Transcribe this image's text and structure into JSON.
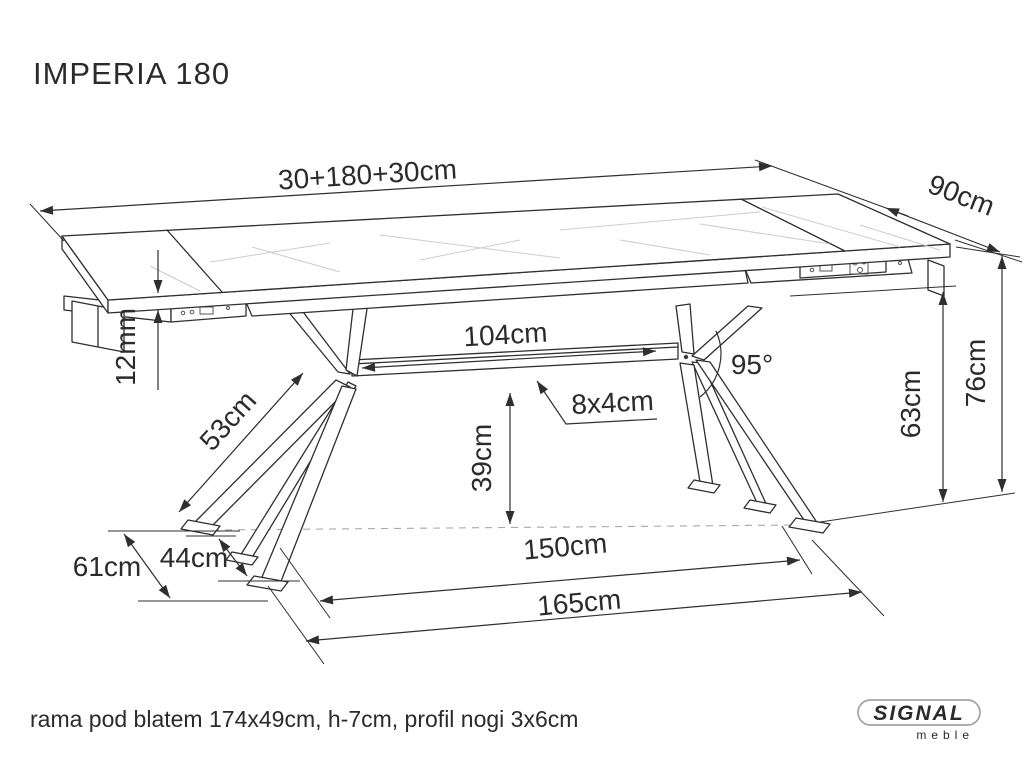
{
  "header": {
    "title": "IMPERIA 180"
  },
  "dimensions": {
    "total_length": "30+180+30cm",
    "depth": "90cm",
    "top_thickness": "12mm",
    "leg_length": "53cm",
    "beam_length": "104cm",
    "leg_angle": "95°",
    "beam_profile": "8x4cm",
    "beam_height": "39cm",
    "underside_height": "63cm",
    "table_height": "76cm",
    "base_depth_outer": "61cm",
    "base_depth_inner": "44cm",
    "base_span_inner": "150cm",
    "base_span_outer": "165cm"
  },
  "footer": {
    "note": "rama pod blatem 174x49cm, h-7cm, profil nogi 3x6cm"
  },
  "brand": {
    "wordmark": "SIGNAL",
    "subtext": "meble"
  }
}
